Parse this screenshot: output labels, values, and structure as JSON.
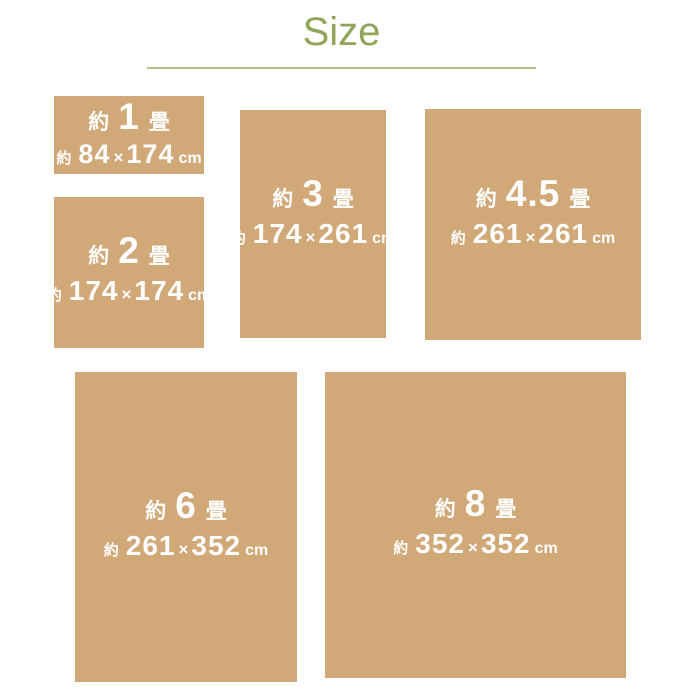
{
  "colors": {
    "background": "#ffffff",
    "card_fill": "#d1a877",
    "card_text": "#ffffff",
    "title_green": "#90a557",
    "underline_green": "#afc18e"
  },
  "title": {
    "text": "Size"
  },
  "cards": [
    {
      "name": "1-jo",
      "prefix": "約",
      "count": "1",
      "suffix": "畳",
      "dim_prefix": "約",
      "width_cm": "84",
      "times": "×",
      "height_cm": "174",
      "unit": "cm"
    },
    {
      "name": "2-jo",
      "prefix": "約",
      "count": "2",
      "suffix": "畳",
      "dim_prefix": "約",
      "width_cm": "174",
      "times": "×",
      "height_cm": "174",
      "unit": "cm"
    },
    {
      "name": "3-jo",
      "prefix": "約",
      "count": "3",
      "suffix": "畳",
      "dim_prefix": "約",
      "width_cm": "174",
      "times": "×",
      "height_cm": "261",
      "unit": "cm"
    },
    {
      "name": "4.5-jo",
      "prefix": "約",
      "count": "4.5",
      "suffix": "畳",
      "dim_prefix": "約",
      "width_cm": "261",
      "times": "×",
      "height_cm": "261",
      "unit": "cm"
    },
    {
      "name": "6-jo",
      "prefix": "約",
      "count": "6",
      "suffix": "畳",
      "dim_prefix": "約",
      "width_cm": "261",
      "times": "×",
      "height_cm": "352",
      "unit": "cm"
    },
    {
      "name": "8-jo",
      "prefix": "約",
      "count": "8",
      "suffix": "畳",
      "dim_prefix": "約",
      "width_cm": "352",
      "times": "×",
      "height_cm": "352",
      "unit": "cm"
    }
  ]
}
